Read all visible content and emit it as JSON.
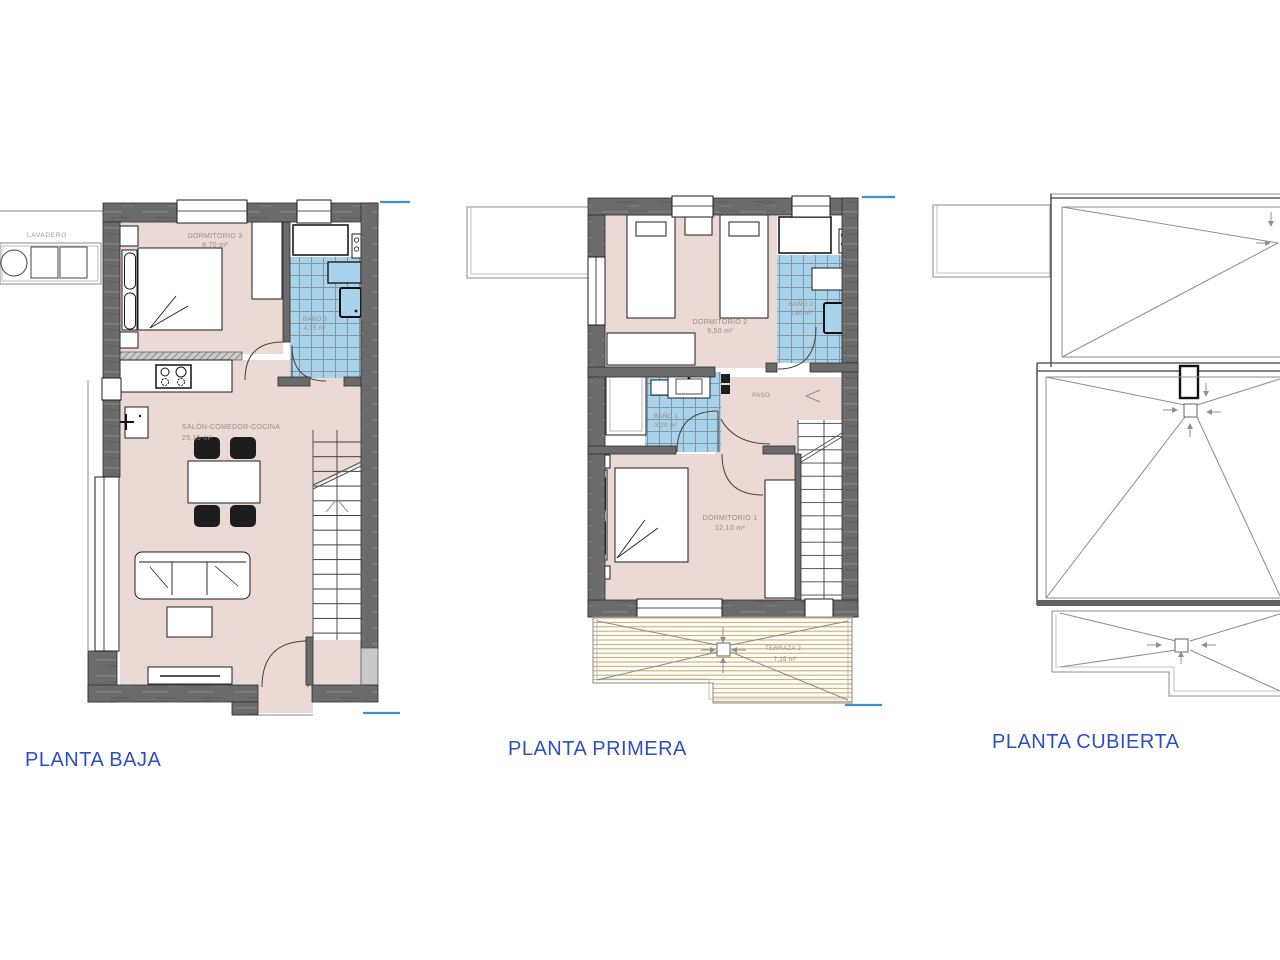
{
  "titles": {
    "baja": "PLANTA BAJA",
    "primera": "PLANTA PRIMERA",
    "cubierta": "PLANTA CUBIERTA"
  },
  "rooms": {
    "baja": {
      "lavadero": {
        "name": "LAVADERO"
      },
      "dormitorio3": {
        "name": "DORMITORIO 3",
        "area": "8,70 m²"
      },
      "bano3": {
        "name": "BAÑO 3",
        "area": "4,15 m²"
      },
      "salon": {
        "name": "SALÓN-COMEDOR-COCINA",
        "area": "25,15 m²"
      }
    },
    "primera": {
      "dormitorio2": {
        "name": "DORMITORIO 2",
        "area": "9,50 m²"
      },
      "bano2": {
        "name": "BAÑO 2",
        "area": "3,80 m²"
      },
      "bano1": {
        "name": "BAÑO 1",
        "area": "3,20 m²"
      },
      "paso": {
        "name": "PASO"
      },
      "dormitorio1": {
        "name": "DORMITORIO 1",
        "area": "12,10 m²"
      },
      "terraza2": {
        "name": "TERRAZA 2",
        "area": "7,15 m²"
      }
    }
  },
  "colors": {
    "wall": "#6b6b6b",
    "floor": "#EAD9D4",
    "tile": "#A8D3EA",
    "tile_grid": "#7E97A6",
    "wood": "#B3994E",
    "title": "#2C4FC9",
    "label": "#9A8B82",
    "dim_blue": "#3C8EDC",
    "line_gray": "#8C8C8C"
  }
}
